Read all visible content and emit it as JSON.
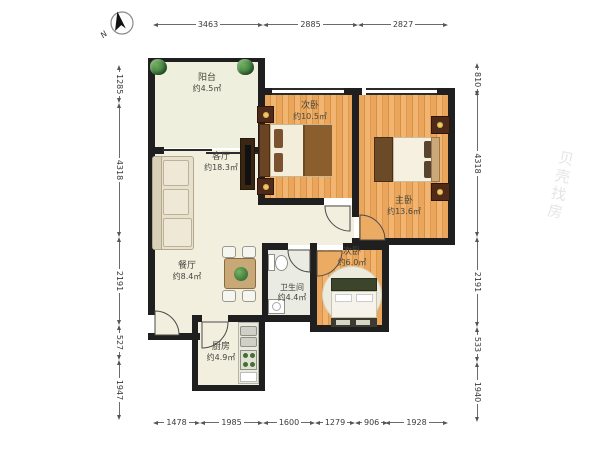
{
  "compass": {
    "label": "N"
  },
  "rooms": [
    {
      "name": "阳台",
      "area": "约4.5㎡"
    },
    {
      "name": "次卧",
      "area": "约10.5㎡"
    },
    {
      "name": "主卧",
      "area": "约13.6㎡"
    },
    {
      "name": "客厅",
      "area": "约18.3㎡"
    },
    {
      "name": "餐厅",
      "area": "约8.4㎡"
    },
    {
      "name": "卫生间",
      "area": "约4.4㎡"
    },
    {
      "name": "次卧",
      "area": "约6.0㎡"
    },
    {
      "name": "厨房",
      "area": "约4.9㎡"
    }
  ],
  "dimensions": {
    "top": [
      "3463",
      "2885",
      "2827"
    ],
    "bottom": [
      "1478",
      "1985",
      "1600",
      "1279",
      "906",
      "1928"
    ],
    "left": [
      "1285",
      "4318",
      "2191",
      "527",
      "1947"
    ],
    "right": [
      "810",
      "4318",
      "2191",
      "533",
      "1940"
    ]
  },
  "watermark": {
    "text": "贝壳找房"
  },
  "colors": {
    "wall": "#1f1f1f",
    "floor_living": "#f2efdf",
    "floor_wood": "#eaa65c",
    "floor_bath": "#eaece3",
    "plant_green": "#3f7c3f"
  }
}
